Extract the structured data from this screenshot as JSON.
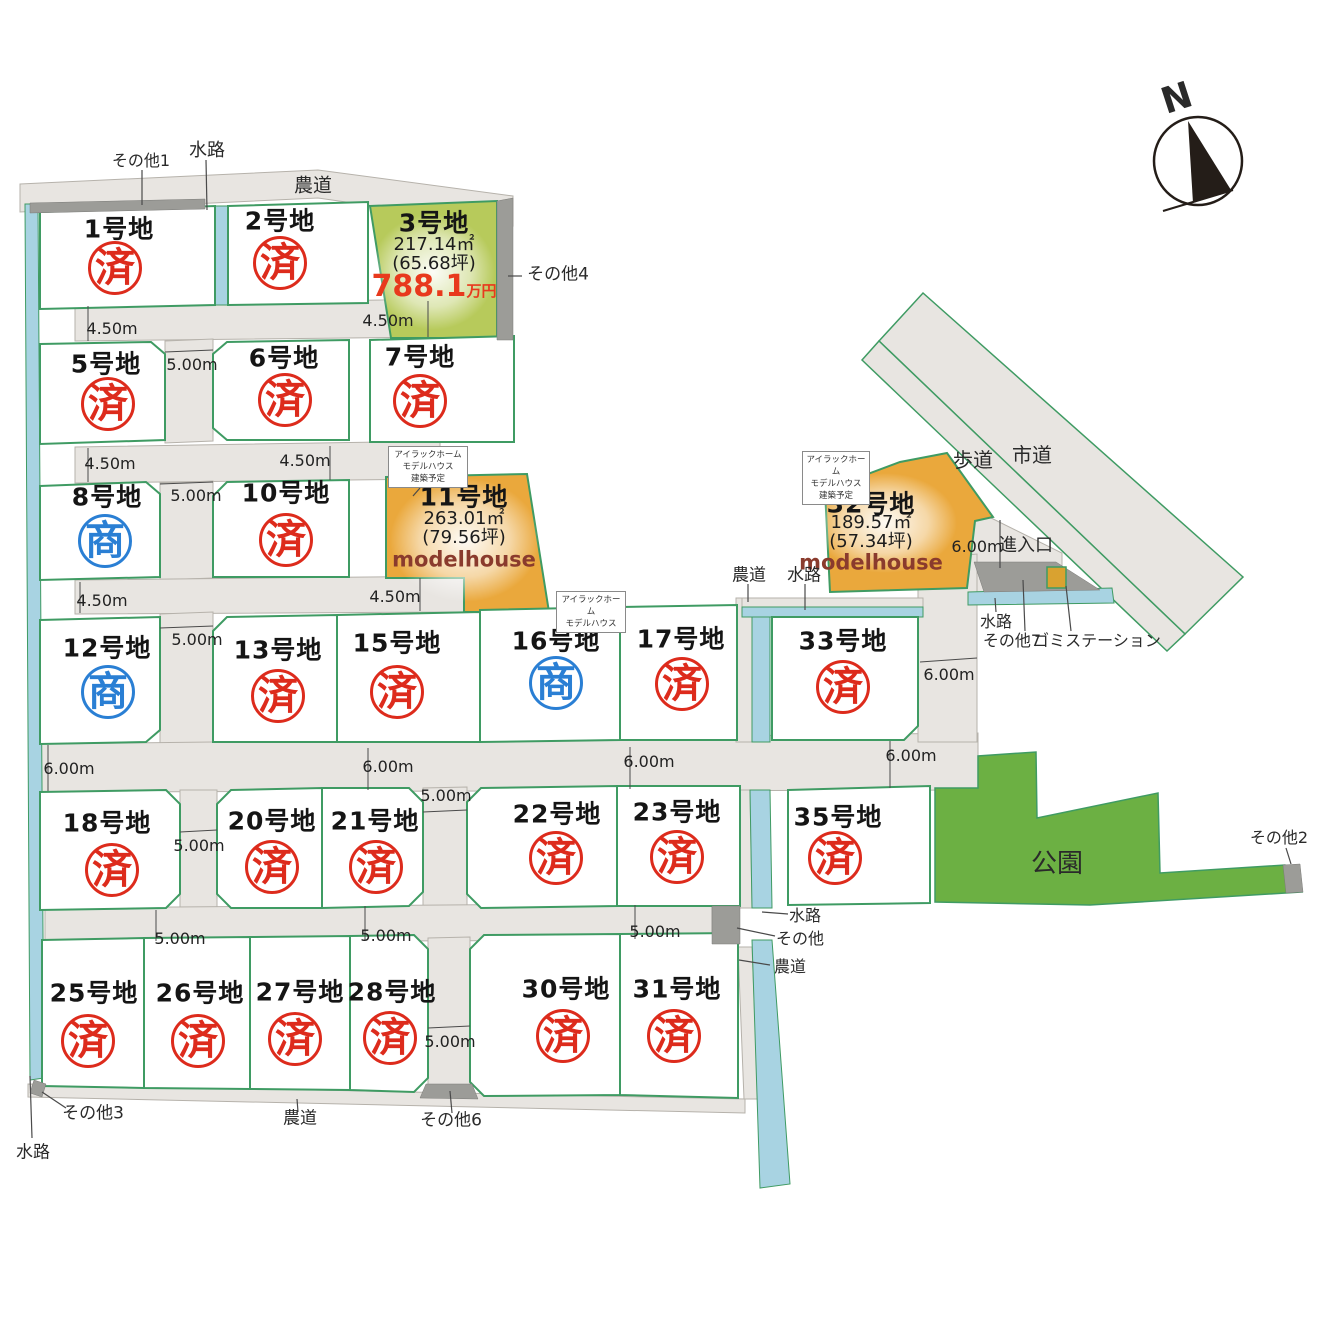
{
  "compass": {
    "label": "N"
  },
  "colors": {
    "sold_stamp": "#dd2b1c",
    "negotiation_stamp": "#2a7fd4",
    "available_lot_fill": "#b7ca5b",
    "modelhouse_lot_fill": "#eaa83c",
    "park_fill": "#6cb043",
    "road_fill": "#e8e5e1",
    "water_fill": "#a8d3e2",
    "lot_stroke": "#3f9b63",
    "price_text": "#e8391d",
    "modelhouse_text": "#8a3b2d"
  },
  "lots": [
    {
      "name": "1号地",
      "stamp": "済",
      "kind": "sold",
      "lx": 119,
      "ly": 229,
      "sx": 115,
      "sy": 268
    },
    {
      "name": "2号地",
      "stamp": "済",
      "kind": "sold",
      "lx": 280,
      "ly": 221,
      "sx": 280,
      "sy": 263
    },
    {
      "name": "5号地",
      "stamp": "済",
      "kind": "sold",
      "lx": 106,
      "ly": 364,
      "sx": 108,
      "sy": 404
    },
    {
      "name": "6号地",
      "stamp": "済",
      "kind": "sold",
      "lx": 284,
      "ly": 358,
      "sx": 285,
      "sy": 400
    },
    {
      "name": "7号地",
      "stamp": "済",
      "kind": "sold",
      "lx": 420,
      "ly": 357,
      "sx": 420,
      "sy": 401
    },
    {
      "name": "8号地",
      "stamp": "商",
      "kind": "talk",
      "lx": 107,
      "ly": 497,
      "sx": 105,
      "sy": 541
    },
    {
      "name": "10号地",
      "stamp": "済",
      "kind": "sold",
      "lx": 286,
      "ly": 493,
      "sx": 286,
      "sy": 540
    },
    {
      "name": "12号地",
      "stamp": "商",
      "kind": "talk",
      "lx": 107,
      "ly": 648,
      "sx": 108,
      "sy": 692
    },
    {
      "name": "13号地",
      "stamp": "済",
      "kind": "sold",
      "lx": 278,
      "ly": 650,
      "sx": 278,
      "sy": 696
    },
    {
      "name": "15号地",
      "stamp": "済",
      "kind": "sold",
      "lx": 397,
      "ly": 643,
      "sx": 397,
      "sy": 692
    },
    {
      "name": "16号地",
      "stamp": "商",
      "kind": "talk",
      "lx": 556,
      "ly": 641,
      "sx": 556,
      "sy": 683
    },
    {
      "name": "17号地",
      "stamp": "済",
      "kind": "sold",
      "lx": 681,
      "ly": 639,
      "sx": 682,
      "sy": 684
    },
    {
      "name": "33号地",
      "stamp": "済",
      "kind": "sold",
      "lx": 843,
      "ly": 641,
      "sx": 843,
      "sy": 687
    },
    {
      "name": "18号地",
      "stamp": "済",
      "kind": "sold",
      "lx": 107,
      "ly": 823,
      "sx": 112,
      "sy": 870
    },
    {
      "name": "20号地",
      "stamp": "済",
      "kind": "sold",
      "lx": 272,
      "ly": 821,
      "sx": 272,
      "sy": 867
    },
    {
      "name": "21号地",
      "stamp": "済",
      "kind": "sold",
      "lx": 375,
      "ly": 821,
      "sx": 376,
      "sy": 867
    },
    {
      "name": "22号地",
      "stamp": "済",
      "kind": "sold",
      "lx": 557,
      "ly": 814,
      "sx": 556,
      "sy": 858
    },
    {
      "name": "23号地",
      "stamp": "済",
      "kind": "sold",
      "lx": 677,
      "ly": 812,
      "sx": 677,
      "sy": 857
    },
    {
      "name": "35号地",
      "stamp": "済",
      "kind": "sold",
      "lx": 838,
      "ly": 817,
      "sx": 835,
      "sy": 858
    },
    {
      "name": "25号地",
      "stamp": "済",
      "kind": "sold",
      "lx": 94,
      "ly": 993,
      "sx": 88,
      "sy": 1041
    },
    {
      "name": "26号地",
      "stamp": "済",
      "kind": "sold",
      "lx": 200,
      "ly": 993,
      "sx": 198,
      "sy": 1041
    },
    {
      "name": "27号地",
      "stamp": "済",
      "kind": "sold",
      "lx": 300,
      "ly": 992,
      "sx": 295,
      "sy": 1039
    },
    {
      "name": "28号地",
      "stamp": "済",
      "kind": "sold",
      "lx": 392,
      "ly": 992,
      "sx": 390,
      "sy": 1038
    },
    {
      "name": "30号地",
      "stamp": "済",
      "kind": "sold",
      "lx": 566,
      "ly": 989,
      "sx": 563,
      "sy": 1036
    },
    {
      "name": "31号地",
      "stamp": "済",
      "kind": "sold",
      "lx": 677,
      "ly": 989,
      "sx": 674,
      "sy": 1036
    }
  ],
  "featured": [
    {
      "name": "3号地",
      "cx": 434,
      "name_y": 223,
      "rows": [
        {
          "t": "217.14㎡",
          "y": 245,
          "cls": "area"
        },
        {
          "t": "(65.68坪)",
          "y": 264,
          "cls": "area"
        }
      ],
      "price": {
        "value": "788.1",
        "unit": "万円",
        "y": 287
      }
    },
    {
      "name": "11号地",
      "cx": 464,
      "name_y": 497,
      "rows": [
        {
          "t": "263.01㎡",
          "y": 519,
          "cls": "area"
        },
        {
          "t": "(79.56坪)",
          "y": 538,
          "cls": "area"
        },
        {
          "t": "modelhouse",
          "y": 560,
          "cls": "mh"
        }
      ]
    },
    {
      "name": "32号地",
      "cx": 871,
      "name_y": 504,
      "rows": [
        {
          "t": "189.57㎡",
          "y": 523,
          "cls": "area"
        },
        {
          "t": "(57.34坪)",
          "y": 542,
          "cls": "area"
        },
        {
          "t": "modelhouse",
          "y": 563,
          "cls": "mh"
        }
      ]
    }
  ],
  "dimensions": [
    {
      "t": "4.50m",
      "x": 112,
      "y": 329
    },
    {
      "t": "4.50m",
      "x": 388,
      "y": 321
    },
    {
      "t": "5.00m",
      "x": 192,
      "y": 365
    },
    {
      "t": "4.50m",
      "x": 110,
      "y": 464
    },
    {
      "t": "4.50m",
      "x": 305,
      "y": 461
    },
    {
      "t": "5.00m",
      "x": 196,
      "y": 496
    },
    {
      "t": "4.50m",
      "x": 102,
      "y": 601
    },
    {
      "t": "4.50m",
      "x": 395,
      "y": 597
    },
    {
      "t": "5.00m",
      "x": 197,
      "y": 640
    },
    {
      "t": "6.00m",
      "x": 69,
      "y": 769
    },
    {
      "t": "6.00m",
      "x": 388,
      "y": 767
    },
    {
      "t": "6.00m",
      "x": 649,
      "y": 762
    },
    {
      "t": "6.00m",
      "x": 911,
      "y": 756
    },
    {
      "t": "5.00m",
      "x": 199,
      "y": 846
    },
    {
      "t": "5.00m",
      "x": 446,
      "y": 796
    },
    {
      "t": "5.00m",
      "x": 180,
      "y": 939
    },
    {
      "t": "5.00m",
      "x": 386,
      "y": 936
    },
    {
      "t": "5.00m",
      "x": 655,
      "y": 932
    },
    {
      "t": "5.00m",
      "x": 450,
      "y": 1042
    },
    {
      "t": "6.00m",
      "x": 949,
      "y": 675
    },
    {
      "t": "6.00m",
      "x": 977,
      "y": 547
    }
  ],
  "map_labels": [
    {
      "t": "農道",
      "x": 313,
      "y": 186,
      "s": 19
    },
    {
      "t": "水路",
      "x": 207,
      "y": 151,
      "s": 18
    },
    {
      "t": "その他1",
      "x": 141,
      "y": 161,
      "s": 16
    },
    {
      "t": "その他4",
      "x": 558,
      "y": 275,
      "s": 17
    },
    {
      "t": "歩道",
      "x": 973,
      "y": 460,
      "s": 20
    },
    {
      "t": "市道",
      "x": 1032,
      "y": 455,
      "s": 20
    },
    {
      "t": "進入口",
      "x": 1026,
      "y": 546,
      "s": 18
    },
    {
      "t": "農道",
      "x": 749,
      "y": 576,
      "s": 17
    },
    {
      "t": "水路",
      "x": 804,
      "y": 576,
      "s": 17
    },
    {
      "t": "水路",
      "x": 996,
      "y": 622,
      "s": 16
    },
    {
      "t": "その他7",
      "x": 1012,
      "y": 641,
      "s": 16
    },
    {
      "t": "ゴミステーション",
      "x": 1097,
      "y": 641,
      "s": 16
    },
    {
      "t": "公園",
      "x": 1057,
      "y": 864,
      "s": 26
    },
    {
      "t": "その他2",
      "x": 1279,
      "y": 838,
      "s": 16
    },
    {
      "t": "水路",
      "x": 805,
      "y": 916,
      "s": 16
    },
    {
      "t": "その他",
      "x": 800,
      "y": 939,
      "s": 16
    },
    {
      "t": "農道",
      "x": 790,
      "y": 967,
      "s": 16
    },
    {
      "t": "その他3",
      "x": 93,
      "y": 1114,
      "s": 17
    },
    {
      "t": "農道",
      "x": 300,
      "y": 1119,
      "s": 17
    },
    {
      "t": "その他6",
      "x": 451,
      "y": 1121,
      "s": 17
    },
    {
      "t": "水路",
      "x": 33,
      "y": 1153,
      "s": 17
    },
    {
      "t": "N",
      "x": 1177,
      "y": 99,
      "s": 36,
      "r": -18,
      "w": 700
    }
  ],
  "callouts": [
    {
      "lines": [
        "アイラックホーム",
        "モデルハウス",
        "建築予定"
      ],
      "x": 388,
      "y": 446,
      "w": 80,
      "h": 42
    },
    {
      "lines": [
        "アイラックホーム",
        "モデルハウス",
        "建築予定"
      ],
      "x": 802,
      "y": 451,
      "w": 68,
      "h": 42
    },
    {
      "lines": [
        "アイラックホーム",
        "モデルハウス"
      ],
      "x": 556,
      "y": 591,
      "w": 70,
      "h": 29
    }
  ]
}
